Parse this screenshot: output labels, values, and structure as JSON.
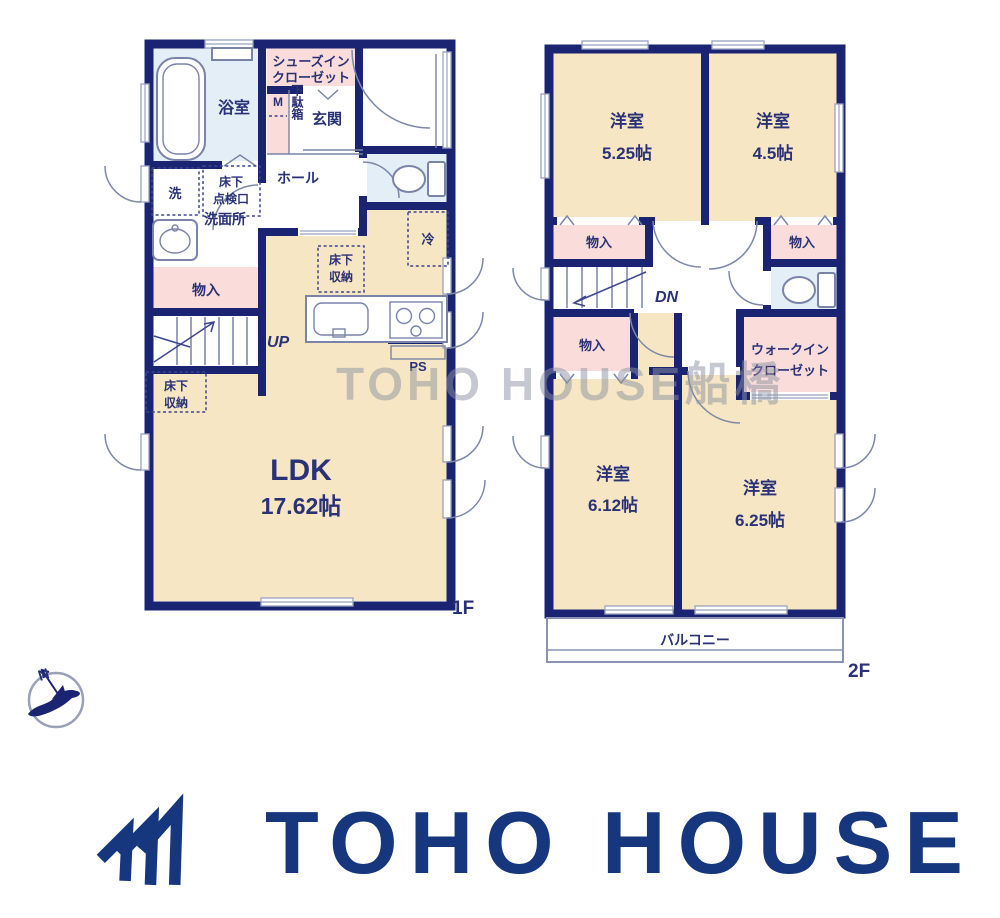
{
  "watermark": "TOHO HOUSE船橋",
  "compass": {
    "north": "N"
  },
  "floor1": {
    "floor_label": "1F",
    "bath": "浴室",
    "shoes_in_closet": [
      "シューズイン",
      "クローゼット"
    ],
    "meter": "M",
    "shoe_cabinet": "下駄箱",
    "entrance": "玄関",
    "hall": "ホール",
    "washer": "洗",
    "underfloor_hatch": [
      "床下",
      "点検口"
    ],
    "washroom": "洗面所",
    "storage": "物入",
    "stairs_up": "UP",
    "underfloor_storage_kitchen": [
      "床下",
      "収納"
    ],
    "underfloor_storage_living": [
      "床下",
      "収納"
    ],
    "fridge": "冷",
    "pipe_space": "PS",
    "ldk_name": "LDK",
    "ldk_size": "17.62帖"
  },
  "floor2": {
    "floor_label": "2F",
    "room_top_left": {
      "name": "洋室",
      "size": "5.25帖"
    },
    "room_top_right": {
      "name": "洋室",
      "size": "4.5帖"
    },
    "room_bottom_left": {
      "name": "洋室",
      "size": "6.12帖"
    },
    "room_bottom_right": {
      "name": "洋室",
      "size": "6.25帖"
    },
    "storage_top_left": "物入",
    "storage_top_right": "物入",
    "storage_mid_left": "物入",
    "stairs_down": "DN",
    "walk_in_closet": [
      "ウォークイン",
      "クローゼット"
    ],
    "balcony": "バルコニー"
  },
  "logo": {
    "text": "TOHO HOUSE"
  },
  "colors": {
    "wall_navy": "#1b2473",
    "room_cream": "#f7e6c3",
    "closet_pink": "#fadcdb",
    "wet_area_blue": "#e4eef6",
    "text_navy": "#2a3277",
    "logo_navy": "#16377e",
    "watermark_gray": "#8d93a3"
  }
}
